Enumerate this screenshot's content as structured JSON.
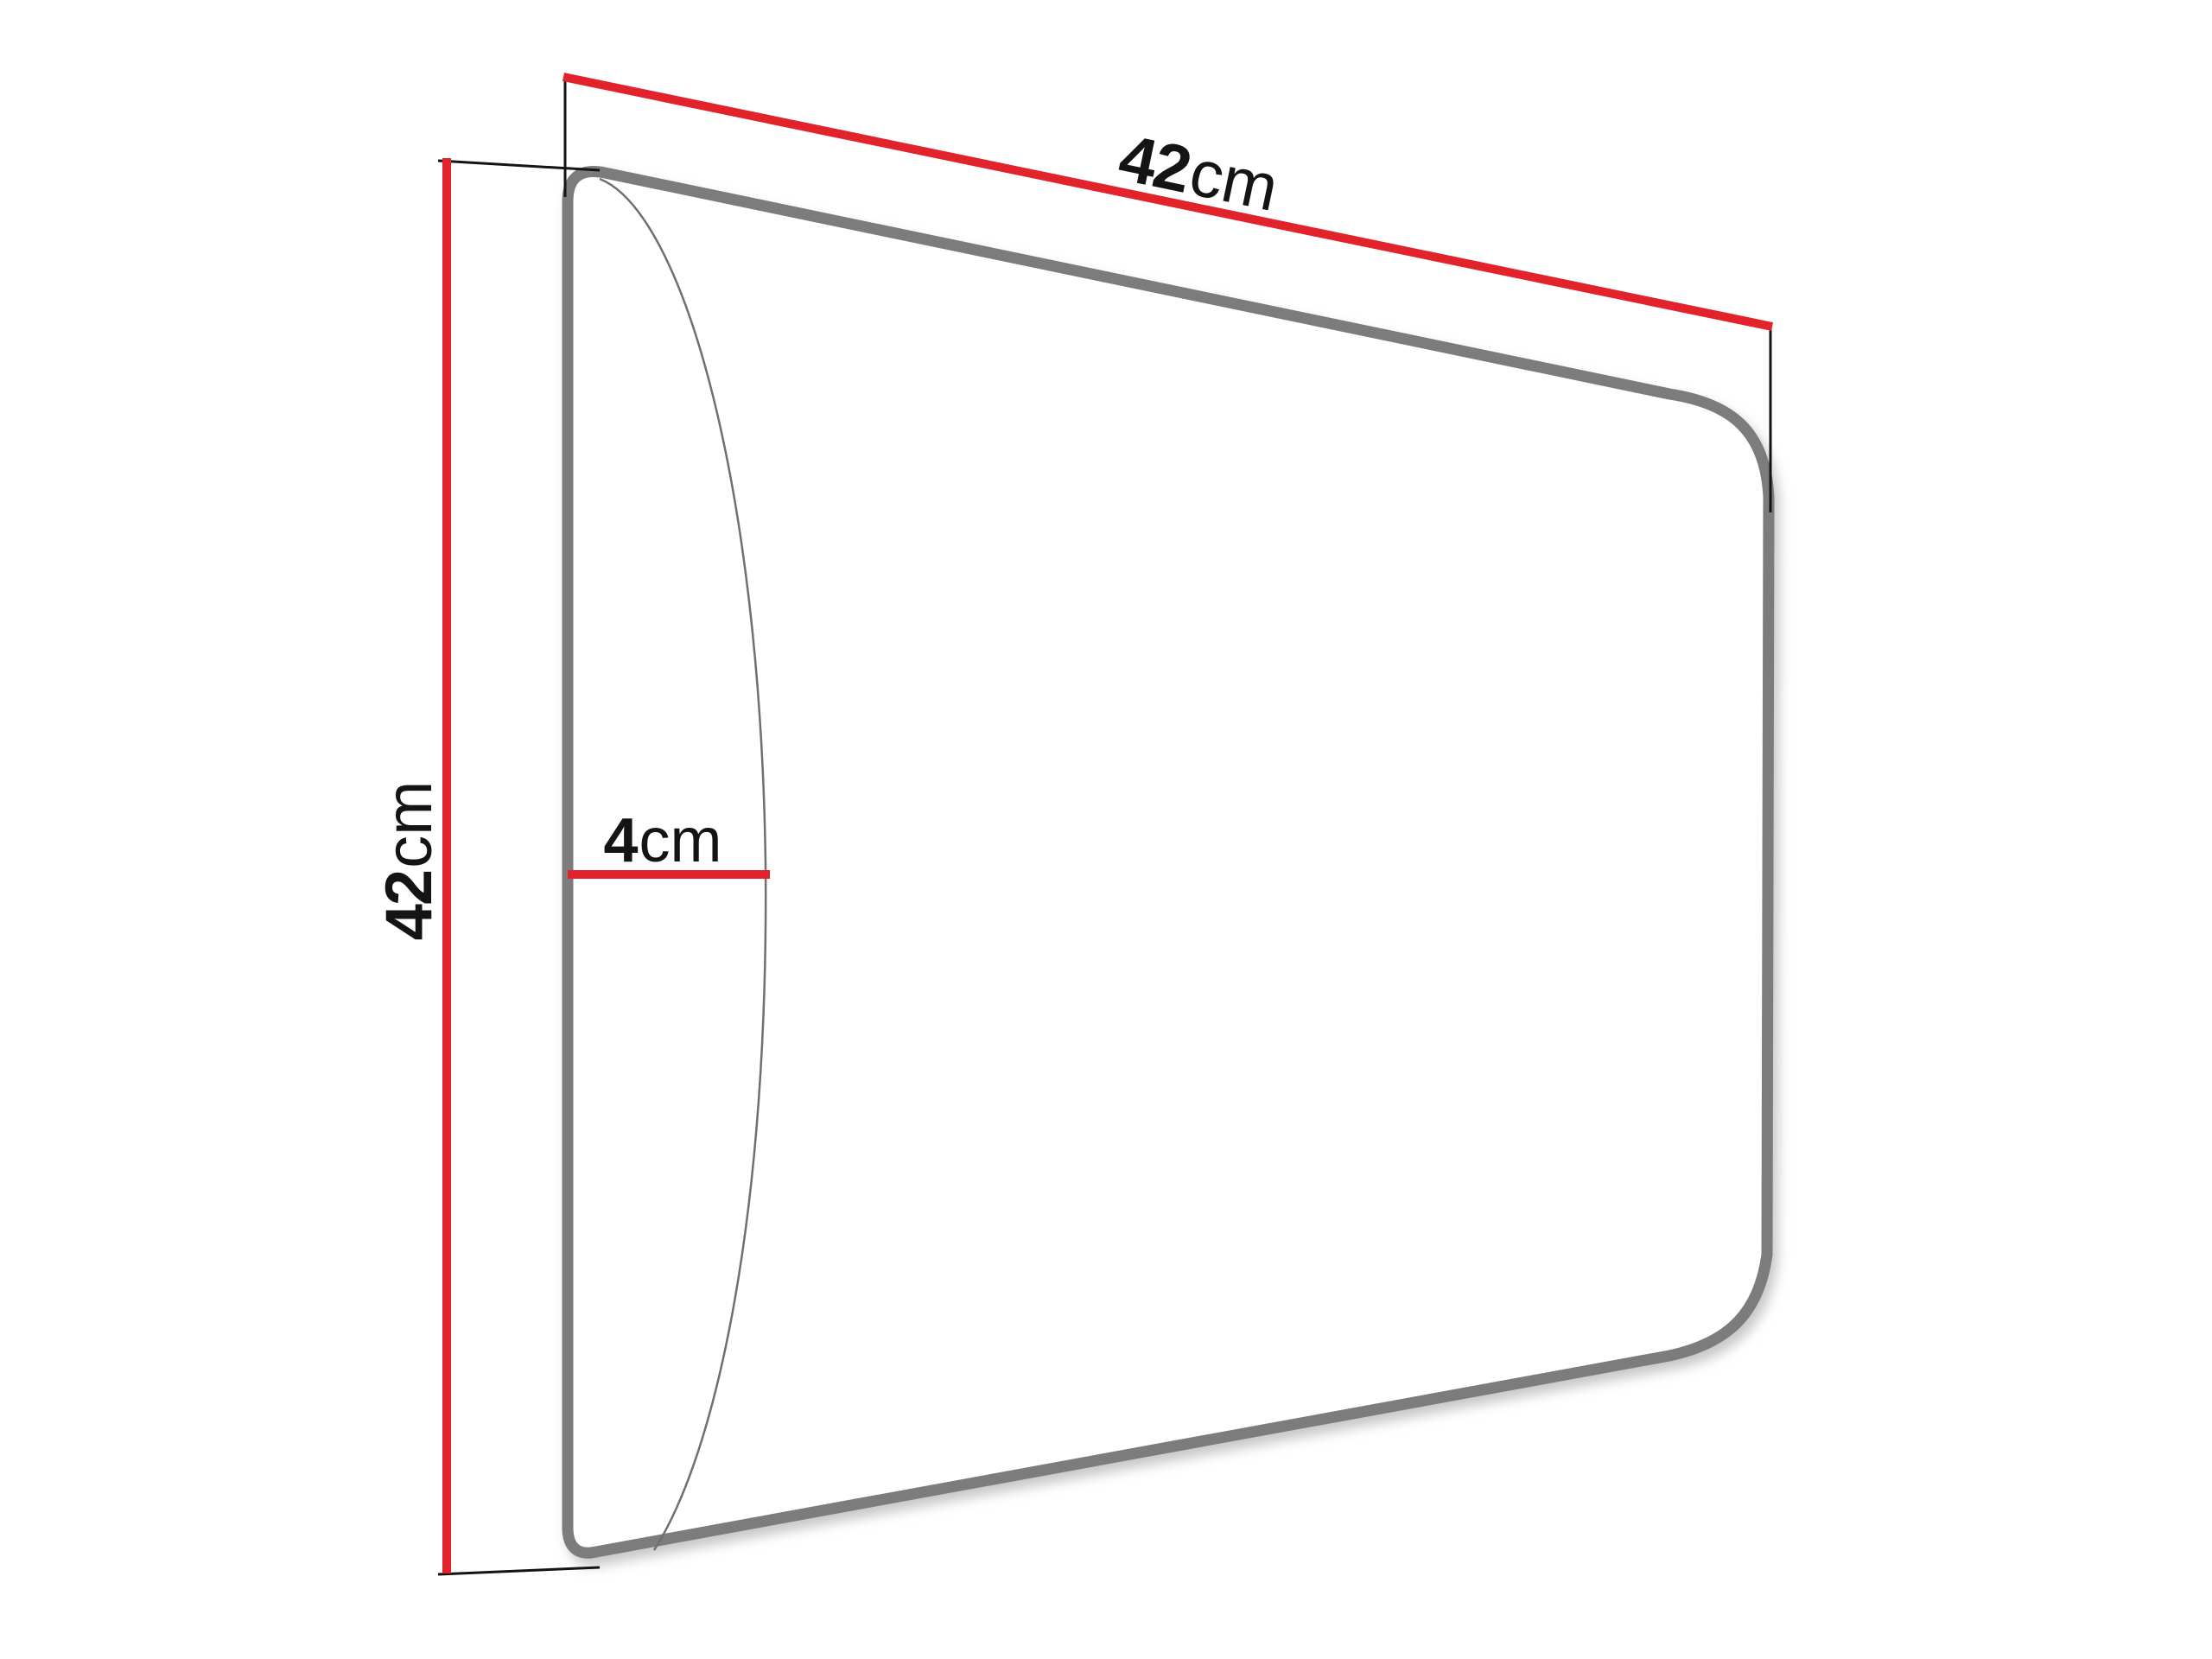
{
  "diagram": {
    "type": "product-dimension-drawing",
    "subject": "upholstered wall panel shown in perspective",
    "labels": {
      "width": {
        "value": "42",
        "unit": "cm"
      },
      "height": {
        "value": "42",
        "unit": "cm"
      },
      "depth": {
        "value": "4",
        "unit": "cm"
      }
    },
    "colors": {
      "dimension_line": "#e2232b",
      "outline": "#7b7b7b",
      "bulge": "#6f6f6f",
      "witness": "#141414",
      "text": "#141414",
      "background": "#ffffff"
    }
  }
}
